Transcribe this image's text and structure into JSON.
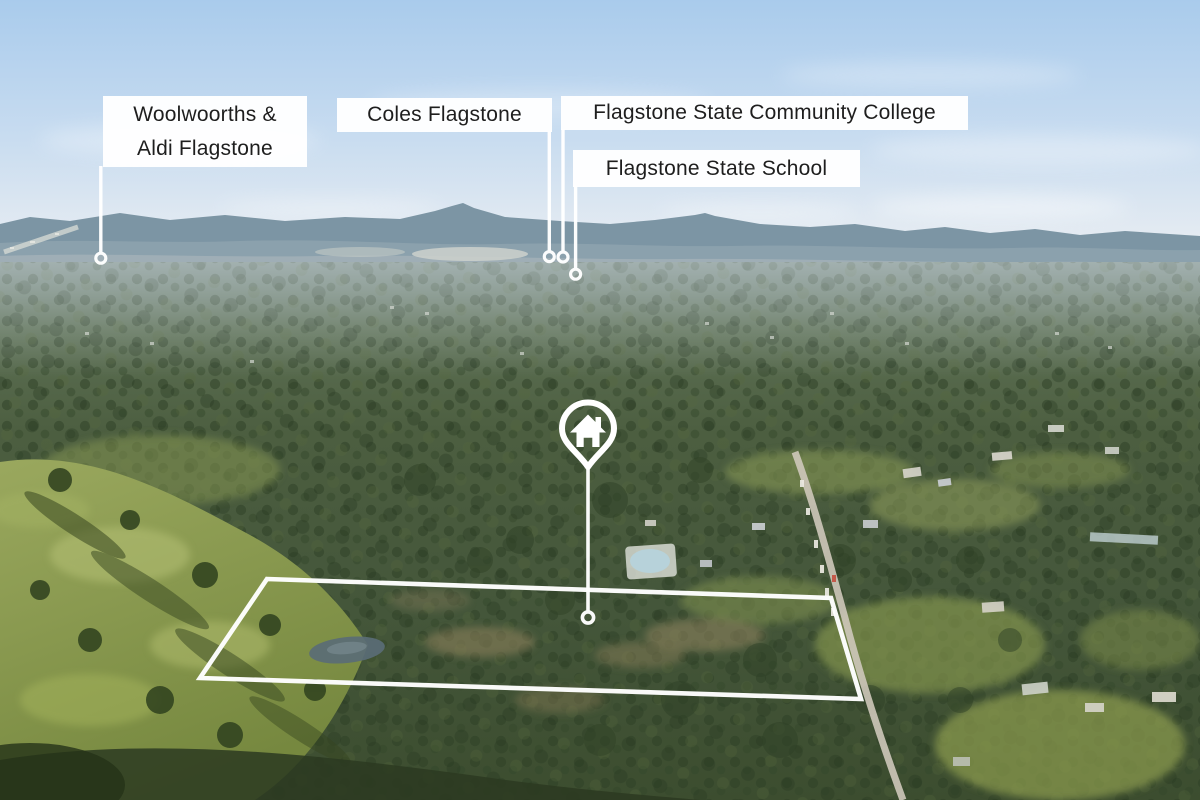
{
  "photo": {
    "description": "Aerial drone photograph over bushland acreage at Flagstone: light blue sky, hazy blue mountain range on the horizon, distant suburban rooftops, dense eucalypt forest, an olive grass paddock at lower left, a road with parked cars at right, a white property boundary outline and a white house location pin linked to the lot.",
    "annotation_color": "#ffffff",
    "sky_color": "#aecdec",
    "mountain_color": "#76909f",
    "forest_color": "#44563a",
    "field_color": "#8c9c52"
  },
  "labels": {
    "woolworths": {
      "line1": "Woolwoorths &",
      "line2": "Aldi Flagstone"
    },
    "coles": {
      "text": "Coles Flagstone"
    },
    "college": {
      "text": "Flagstone State Community College"
    },
    "school": {
      "text": "Flagstone State School"
    }
  },
  "markers": {
    "property_pin_icon": "house-icon",
    "poi_marker_icon": "ring-icon"
  }
}
